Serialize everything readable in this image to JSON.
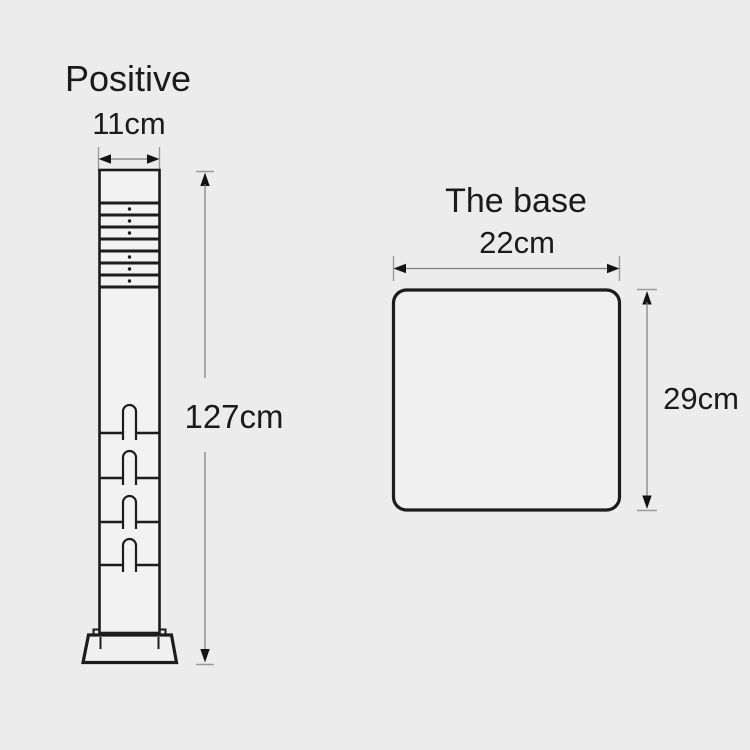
{
  "figures": {
    "post": {
      "title": "Positive",
      "width_label": "11cm",
      "height_label": "127cm"
    },
    "base": {
      "title": "The base",
      "width_label": "22cm",
      "height_label": "29cm"
    }
  },
  "colors": {
    "background": "#ececec",
    "outline": "#1c1c1c",
    "dimension_line": "#7d7d7d",
    "text": "#1b1b1b"
  }
}
